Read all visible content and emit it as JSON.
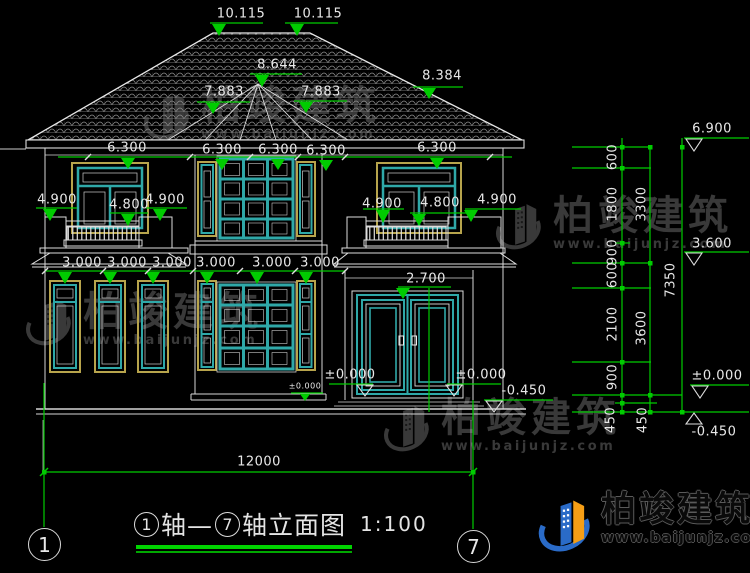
{
  "background": "#000000",
  "colors": {
    "dimension_green": "#00cc00",
    "line_white": "#e0e0e0",
    "window_teal": "#2fa8a8",
    "frame_yellow": "#b7a44c",
    "watermark_gray": "#3d3d3d",
    "logo_blue": "#2a6bc8",
    "logo_orange": "#f59e16"
  },
  "brand": {
    "name": "柏竣建筑",
    "url": "www.baijunjz.com"
  },
  "drawing_title": {
    "axis_start": "1",
    "mid": "轴—",
    "axis_end": "7",
    "suffix": "轴立面图",
    "scale": "1:100"
  },
  "axis_bubbles": {
    "left": "1",
    "right": "7"
  },
  "overall_dim": "12000",
  "dim_labels": [
    {
      "n": "level-10115-a",
      "t": "10.115",
      "x": 241,
      "y": 14
    },
    {
      "n": "level-10115-b",
      "t": "10.115",
      "x": 318,
      "y": 14
    },
    {
      "n": "level-8644",
      "t": "8.644",
      "x": 277,
      "y": 65
    },
    {
      "n": "level-7883-a",
      "t": "7.883",
      "x": 224,
      "y": 92
    },
    {
      "n": "level-7883-b",
      "t": "7.883",
      "x": 321,
      "y": 92
    },
    {
      "n": "level-8384",
      "t": "8.384",
      "x": 442,
      "y": 76
    },
    {
      "n": "level-6300-a",
      "t": "6.300",
      "x": 127,
      "y": 148
    },
    {
      "n": "level-6300-b",
      "t": "6.300",
      "x": 222,
      "y": 150
    },
    {
      "n": "level-6300-c",
      "t": "6.300",
      "x": 278,
      "y": 150
    },
    {
      "n": "level-6300-d",
      "t": "6.300",
      "x": 326,
      "y": 151
    },
    {
      "n": "level-6300-e",
      "t": "6.300",
      "x": 437,
      "y": 148
    },
    {
      "n": "level-4900-a",
      "t": "4.900",
      "x": 57,
      "y": 200
    },
    {
      "n": "level-4800-a",
      "t": "4.800",
      "x": 129,
      "y": 205
    },
    {
      "n": "level-4900-b",
      "t": "4.900",
      "x": 165,
      "y": 200
    },
    {
      "n": "level-4900-c",
      "t": "4.900",
      "x": 382,
      "y": 204
    },
    {
      "n": "level-4800-b",
      "t": "4.800",
      "x": 440,
      "y": 203
    },
    {
      "n": "level-4900-d",
      "t": "4.900",
      "x": 497,
      "y": 200
    },
    {
      "n": "level-3000-a",
      "t": "3.000",
      "x": 82,
      "y": 263
    },
    {
      "n": "level-3000-b",
      "t": "3.000",
      "x": 127,
      "y": 263
    },
    {
      "n": "level-3000-c",
      "t": "3.000",
      "x": 172,
      "y": 263
    },
    {
      "n": "level-3000-d",
      "t": "3.000",
      "x": 216,
      "y": 263
    },
    {
      "n": "level-3000-e",
      "t": "3.000",
      "x": 272,
      "y": 263
    },
    {
      "n": "level-3000-f",
      "t": "3.000",
      "x": 320,
      "y": 263
    },
    {
      "n": "level-2700",
      "t": "2.700",
      "x": 426,
      "y": 279
    },
    {
      "n": "level-0000-door-left",
      "t": "±0.000",
      "x": 350,
      "y": 375
    },
    {
      "n": "level-0000-door-right",
      "t": "±0.000",
      "x": 481,
      "y": 375
    },
    {
      "n": "level-0000-small",
      "t": "±0.000",
      "x": 305,
      "y": 386,
      "s": 8
    },
    {
      "n": "level-neg0450-house",
      "t": "-0.450",
      "x": 524,
      "y": 391
    },
    {
      "n": "dim-overall-12000",
      "t": "12000",
      "x": 259,
      "y": 462
    },
    {
      "n": "level-6900-right",
      "t": "6.900",
      "x": 712,
      "y": 129
    },
    {
      "n": "level-3600-right",
      "t": "3.600",
      "x": 712,
      "y": 244
    },
    {
      "n": "level-0000-right",
      "t": "±0.000",
      "x": 717,
      "y": 376
    },
    {
      "n": "level-neg0450-right",
      "t": "-0.450",
      "x": 714,
      "y": 432
    },
    {
      "n": "seg-600-a",
      "t": "600",
      "x": 613,
      "y": 157,
      "r": 1
    },
    {
      "n": "seg-1800",
      "t": "1800",
      "x": 613,
      "y": 204,
      "r": 1
    },
    {
      "n": "seg-900-a",
      "t": "900",
      "x": 613,
      "y": 252,
      "r": 1
    },
    {
      "n": "seg-600-b",
      "t": "600",
      "x": 613,
      "y": 275,
      "r": 1
    },
    {
      "n": "seg-2100",
      "t": "2100",
      "x": 613,
      "y": 324,
      "r": 1
    },
    {
      "n": "seg-900-b",
      "t": "900",
      "x": 613,
      "y": 377,
      "r": 1
    },
    {
      "n": "seg-450-a",
      "t": "450",
      "x": 611,
      "y": 420,
      "r": 1
    },
    {
      "n": "seg-450-b",
      "t": "450",
      "x": 643,
      "y": 420,
      "r": 1
    },
    {
      "n": "seg-3300",
      "t": "3300",
      "x": 642,
      "y": 204,
      "r": 1
    },
    {
      "n": "seg-3600",
      "t": "3600",
      "x": 642,
      "y": 328,
      "r": 1
    },
    {
      "n": "seg-7350",
      "t": "7350",
      "x": 671,
      "y": 280,
      "r": 1
    }
  ],
  "watermarks": [
    {
      "x": 142,
      "y": 86
    },
    {
      "x": 24,
      "y": 292
    },
    {
      "x": 494,
      "y": 196
    },
    {
      "x": 382,
      "y": 398
    }
  ]
}
